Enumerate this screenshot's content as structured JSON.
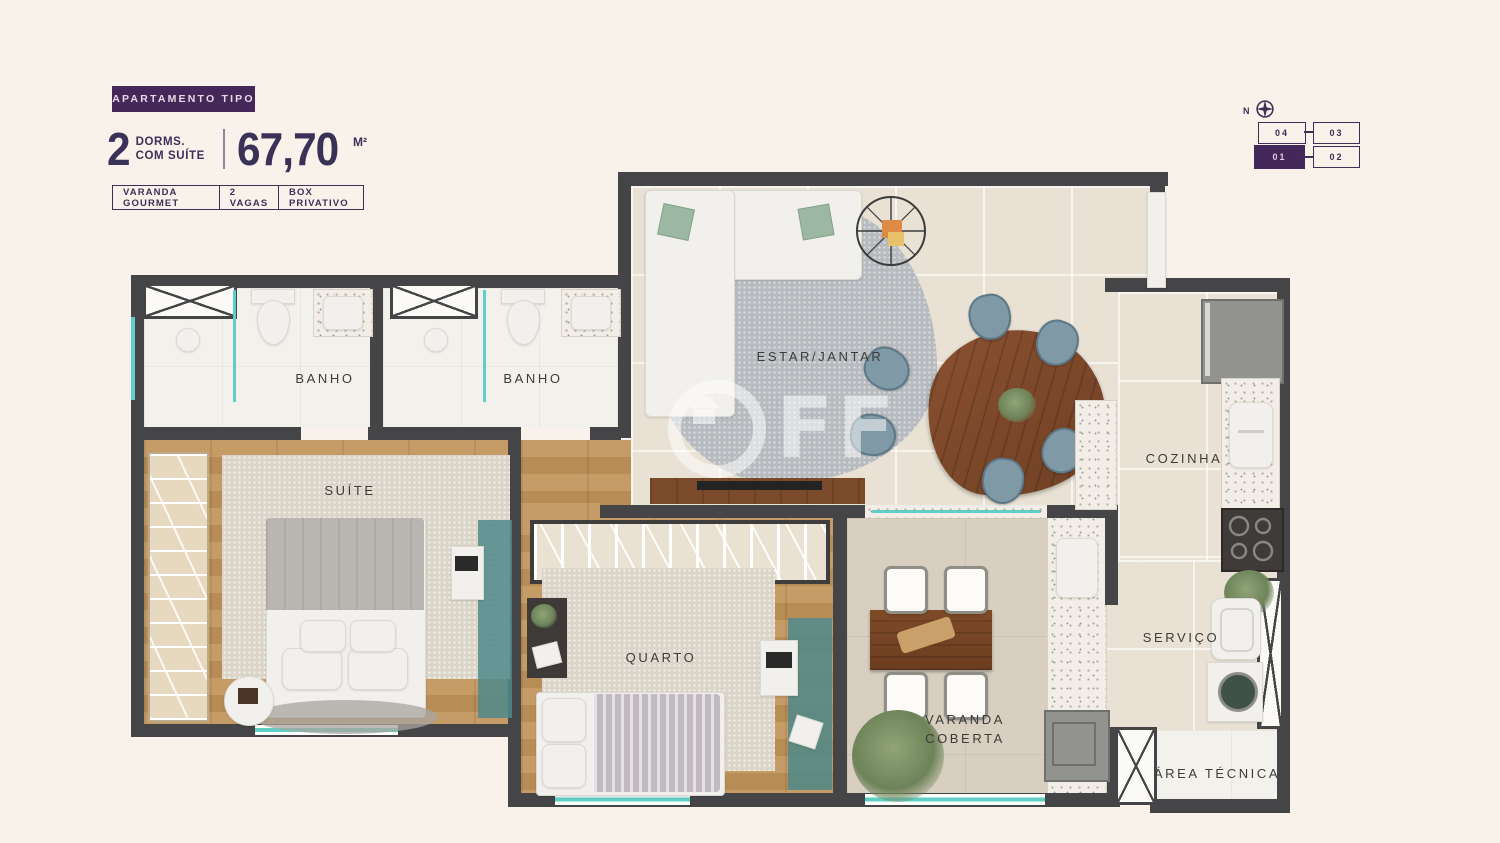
{
  "header": {
    "badge": "APARTAMENTO TIPO",
    "dorms_number": "2",
    "dorms_label_line1": "DORMS.",
    "dorms_label_line2": "COM SUÍTE",
    "area_value": "67,70",
    "area_unit": "M²",
    "features": [
      {
        "label": "VARANDA GOURMET"
      },
      {
        "label": "2 VAGAS"
      },
      {
        "label": "BOX PRIVATIVO"
      }
    ]
  },
  "keyplan": {
    "north_label": "N",
    "units": [
      {
        "id": "04",
        "highlighted": false
      },
      {
        "id": "03",
        "highlighted": false
      },
      {
        "id": "01",
        "highlighted": true
      },
      {
        "id": "02",
        "highlighted": false
      }
    ]
  },
  "floorplan": {
    "labels": {
      "banho_suite": "BANHO",
      "banho_social": "BANHO",
      "estar_jantar": "ESTAR/JANTAR",
      "suite": "SUÍTE",
      "quarto": "QUARTO",
      "cozinha": "COZINHA",
      "servico": "SERVIÇO",
      "varanda_line1": "VARANDA",
      "varanda_line2": "COBERTA",
      "area_tecnica": "ÁREA TÉCNICA"
    }
  },
  "watermark": {
    "letters": "FF"
  },
  "colors": {
    "accent_purple": "#44285a",
    "text_navy": "#3a3157",
    "wall_gray": "#454547",
    "teal_accent": "#5fcfc6",
    "background_cream": "#f8f2ea"
  }
}
